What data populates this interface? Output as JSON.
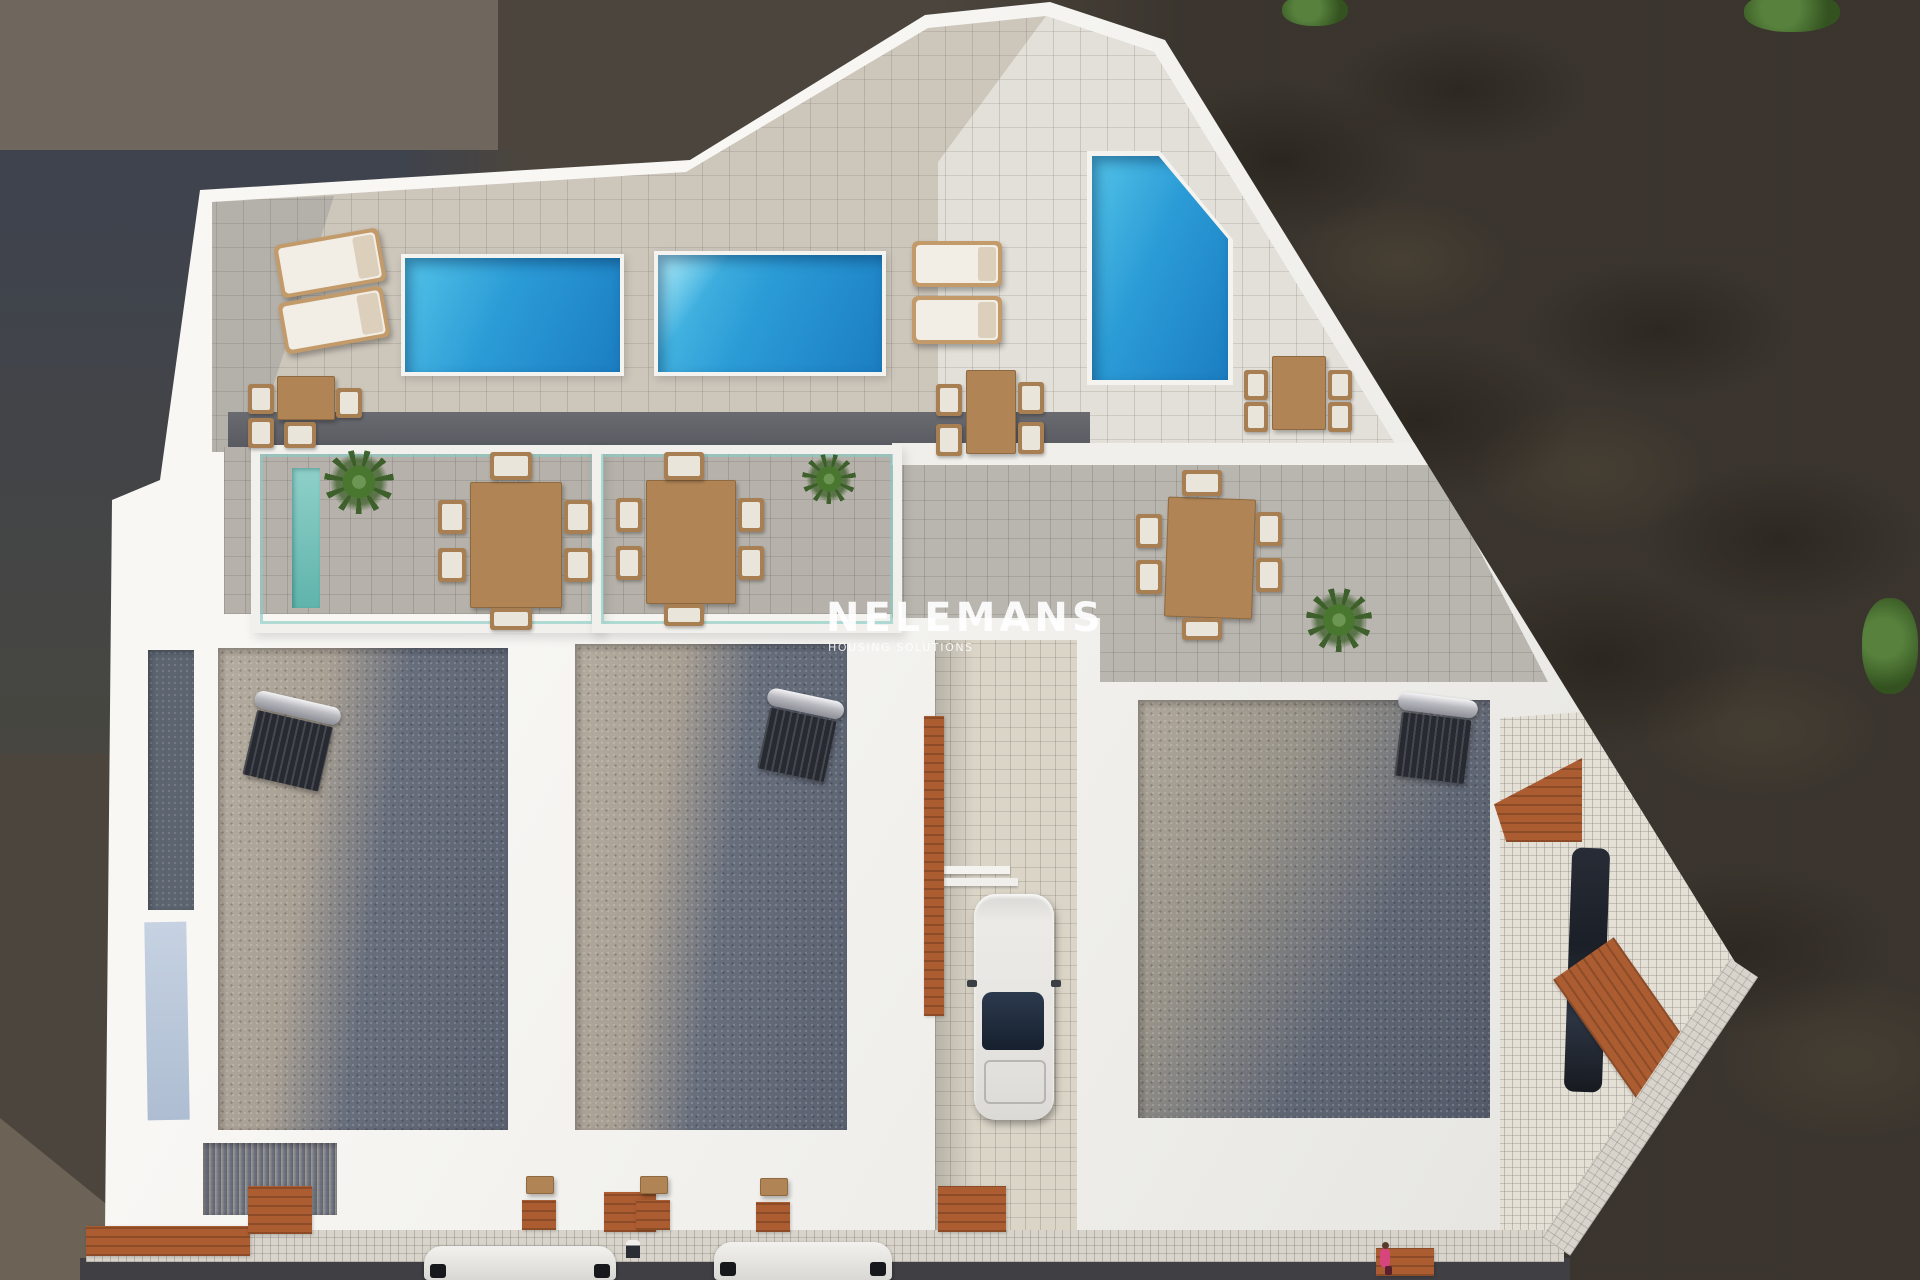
{
  "watermark": {
    "title": "NELEMANS",
    "subtitle": "HOUSING SOLUTIONS"
  },
  "scene": {
    "type": "3d-aerial-architectural-render",
    "description": "Top-down 3D render of a white residential villa development with roof terraces, three swimming pools, sun loungers, dining sets, solar water heaters, a driveway car, street parking and a pedestrian",
    "colors": {
      "pool_water": "#2b9bd6",
      "terrace_tile": "#cbc5ba",
      "lower_terrace_tile": "#b6b2ab",
      "gravel_lit": "#b2aa9e",
      "gravel_shadow": "#5b6170",
      "terracotta_deck": "#ab5c31",
      "white_wall": "#f2f1ee",
      "ground": "#4b453d",
      "glass_balustrade": "#89cbc2"
    },
    "counts": {
      "pools": 3,
      "sun_loungers": 4,
      "dining_tables": 6,
      "solar_water_heaters": 3,
      "street_cars": 2,
      "driveway_cars": 1,
      "plants": 3,
      "bushes": 3,
      "people": 1
    }
  }
}
